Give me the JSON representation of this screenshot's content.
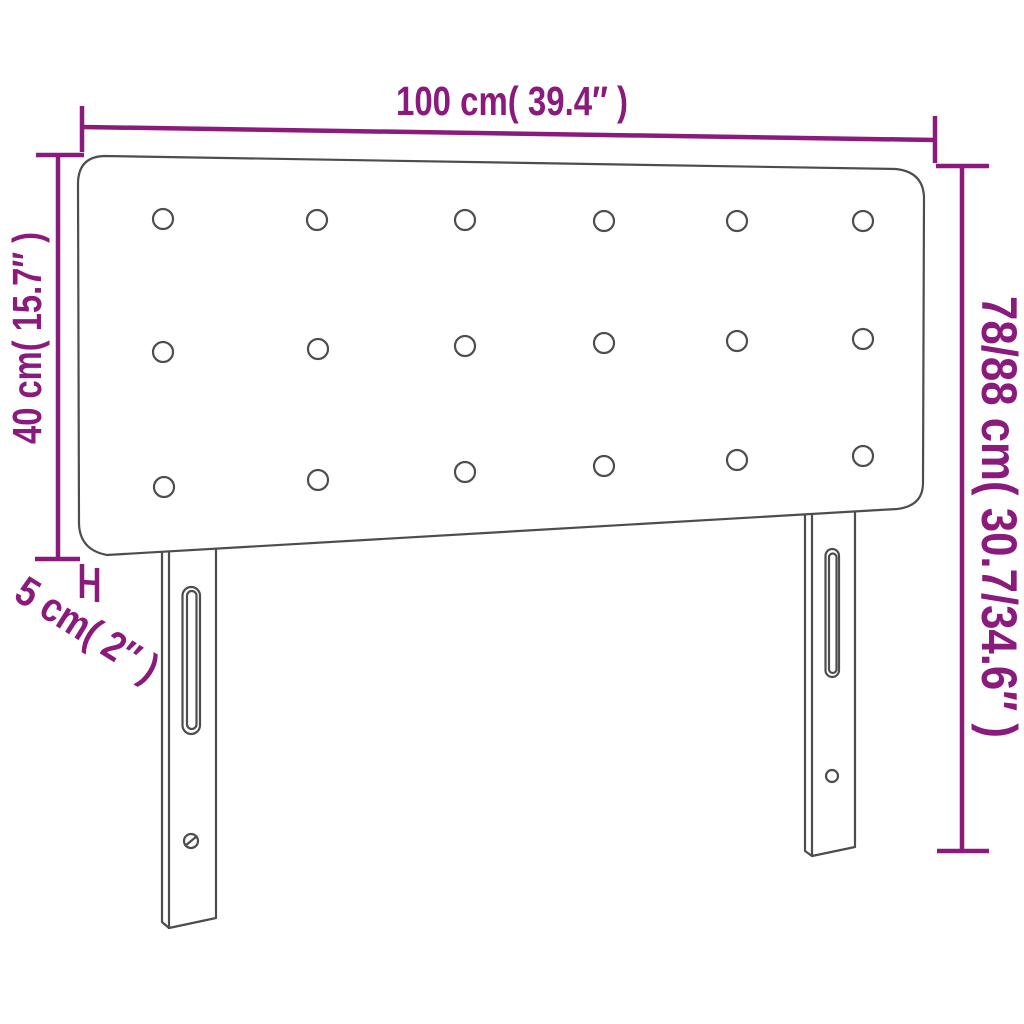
{
  "colors": {
    "dimension_lines": "#8a1b7c",
    "product_outline": "#4d4d4d",
    "background": "#ffffff"
  },
  "product": {
    "type": "headboard",
    "button_rows": 3,
    "button_columns": 6,
    "button_count": 18,
    "leg_count": 2
  },
  "dimensions": {
    "width": {
      "label": "100 cm( 39.4″ )"
    },
    "panel_height": {
      "label": "40 cm( 15.7″ )"
    },
    "total_height": {
      "label": "78/88 cm( 30.7/34.6″ )"
    },
    "depth": {
      "label": "5 cm( 2″ )"
    }
  }
}
